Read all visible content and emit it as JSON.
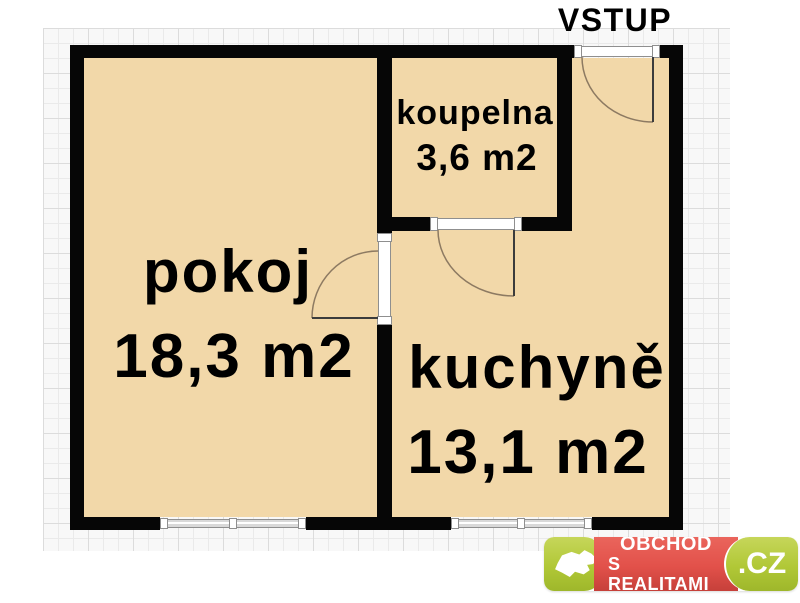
{
  "plan": {
    "entrance_label": "VSTUP",
    "rooms": [
      {
        "name": "pokoj",
        "area": "18,3 m2"
      },
      {
        "name": "kuchyně",
        "area": "13,1 m2"
      },
      {
        "name": "koupelna",
        "area": "3,6 m2"
      }
    ]
  },
  "logo": {
    "line1": "OBCHOD",
    "line2": "S REALITAMI",
    "tld": ".CZ"
  },
  "colors": {
    "room_fill": "#f2d8a9",
    "wall": "#060606",
    "grid_line": "#eaeaea",
    "logo_green": "#b1c837",
    "logo_red": "#e2514a",
    "logo_text": "#ffffff"
  }
}
